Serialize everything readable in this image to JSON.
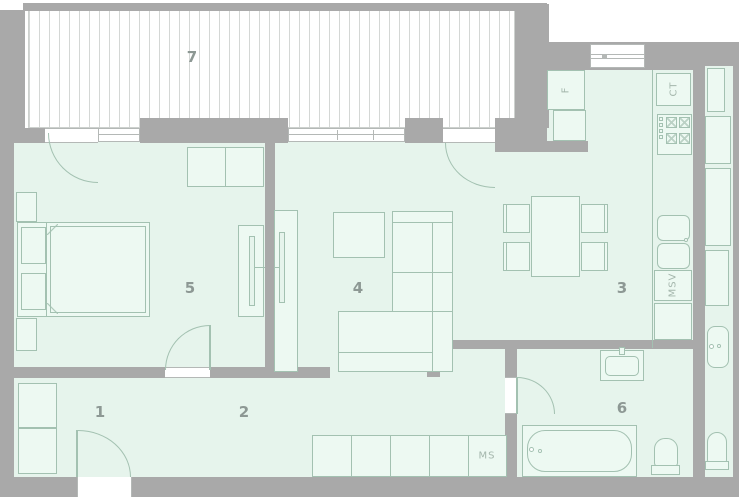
{
  "rooms": [
    {
      "number": "1"
    },
    {
      "number": "2"
    },
    {
      "number": "3"
    },
    {
      "number": "4"
    },
    {
      "number": "5"
    },
    {
      "number": "6"
    },
    {
      "number": "7"
    }
  ],
  "fixtures": {
    "fridge_label": "F",
    "counter_label": "CT",
    "msv_label": "MSV",
    "ms_label": "MS"
  },
  "colors": {
    "wall": "#a9a9a9",
    "floor": "#e6f4ec",
    "furniture_stroke": "#a3c1b1",
    "balcony_hatch": "#d4d7d5"
  }
}
